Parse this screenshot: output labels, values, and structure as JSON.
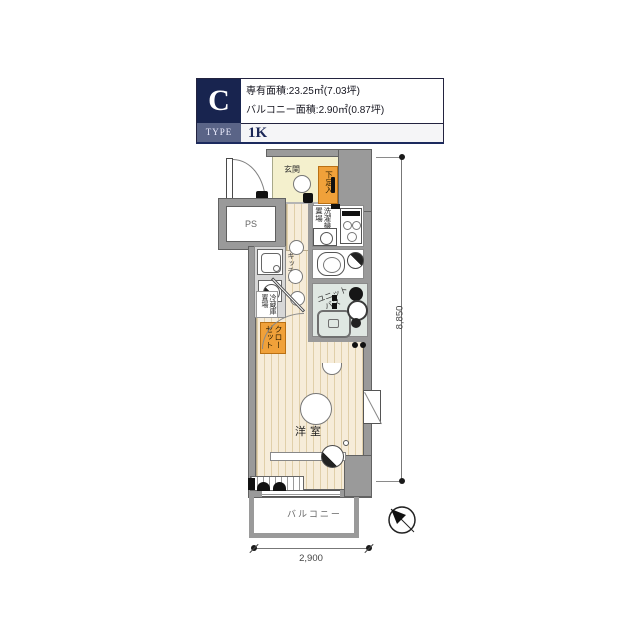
{
  "header": {
    "type_letter": "C",
    "type_word": "TYPE",
    "layout": "1K",
    "area_line1": "専有面積:23.25㎡(7.03坪)",
    "area_line2": "バルコニー面積:2.90㎡(0.87坪)"
  },
  "labels": {
    "entrance": "玄関",
    "shoe_box": "下足入",
    "ps": "PS",
    "washer_place": "洗濯機置場",
    "kitchen": "キッチン",
    "fridge_place": "冷蔵庫置場",
    "closet": "クローゼット",
    "unit_bath_line1": "ユニット",
    "unit_bath_line2": "バス",
    "room": "洋室",
    "balcony": "バルコニー"
  },
  "dimensions": {
    "balcony_width_mm": "2,900",
    "unit_depth_mm": "8,850"
  },
  "icons": {
    "north_arrow": "compass pointing north-west"
  },
  "colors": {
    "accent_navy": "#18244f",
    "type_bar": "#5a6487",
    "closet_orange": "#f0a13a",
    "wood_floor": "#f6ecd9",
    "entrance_floor": "#f4f0cd",
    "bath_floor": "#dfe7e2",
    "wall_gray": "#9a9a9a"
  }
}
